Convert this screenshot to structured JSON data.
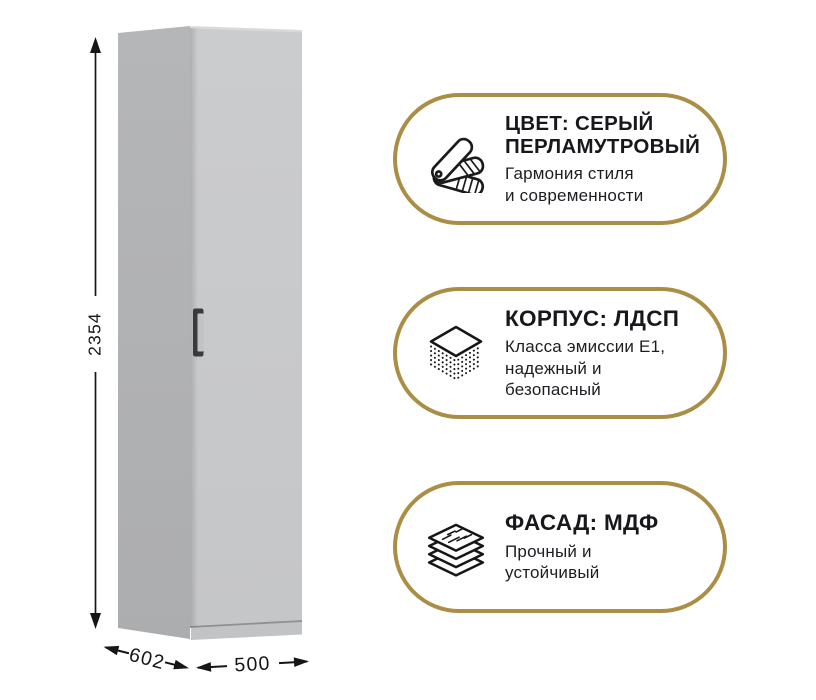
{
  "dimensions": {
    "height_mm": "2354",
    "depth_mm": "602",
    "width_mm": "500"
  },
  "badges": [
    {
      "icon": "color-fan-icon",
      "title_lines": [
        "ЦВЕТ: СЕРЫЙ",
        "ПЕРЛАМУТРОВЫЙ"
      ],
      "subtitle_lines": [
        "Гармония стиля",
        "и современности"
      ]
    },
    {
      "icon": "chipboard-layers-icon",
      "title_lines": [
        "КОРПУС: ЛДСП"
      ],
      "subtitle_lines": [
        "Класса эмиссии Е1,",
        "надежный и",
        "безопасный"
      ]
    },
    {
      "icon": "mdf-sheets-icon",
      "title_lines": [
        "ФАСАД: МДФ"
      ],
      "subtitle_lines": [
        "Прочный и",
        "устойчивый"
      ]
    }
  ],
  "colors": {
    "accent_gold": "#ab8e46",
    "text_dark": "#17171c",
    "wardrobe_side": "#b2b3b5",
    "wardrobe_front": "#c8c9cb",
    "wardrobe_top_edge": "#d8d9da",
    "handle_dark": "#3a3b3d"
  }
}
